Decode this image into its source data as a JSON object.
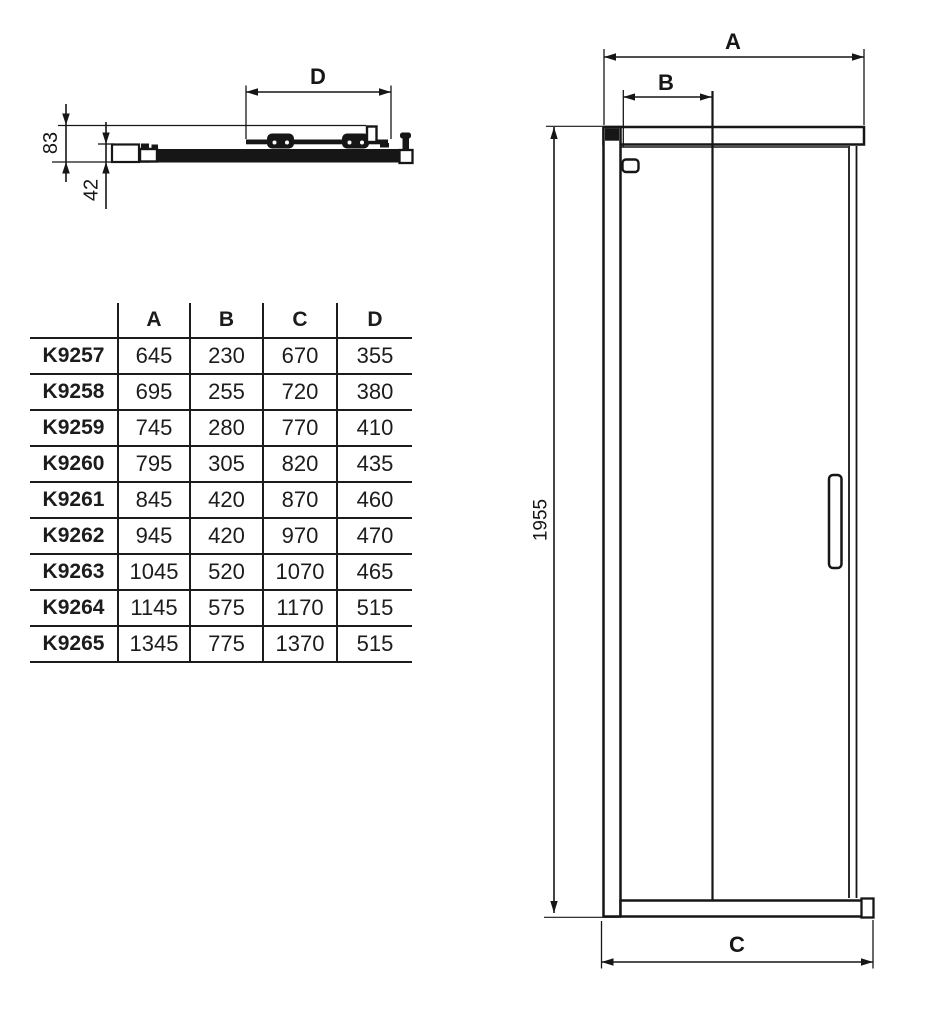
{
  "drawing": {
    "profile_section": {
      "dim_d": "D",
      "dim_depth": "83",
      "dim_inner": "42"
    },
    "elevation": {
      "dim_a": "A",
      "dim_b": "B",
      "dim_c": "C",
      "dim_height": "1955"
    }
  },
  "table": {
    "headers": [
      "A",
      "B",
      "C",
      "D"
    ],
    "rows": [
      {
        "model": "K9257",
        "values": [
          "645",
          "230",
          "670",
          "355"
        ]
      },
      {
        "model": "K9258",
        "values": [
          "695",
          "255",
          "720",
          "380"
        ]
      },
      {
        "model": "K9259",
        "values": [
          "745",
          "280",
          "770",
          "410"
        ]
      },
      {
        "model": "K9260",
        "values": [
          "795",
          "305",
          "820",
          "435"
        ]
      },
      {
        "model": "K9261",
        "values": [
          "845",
          "420",
          "870",
          "460"
        ]
      },
      {
        "model": "K9262",
        "values": [
          "945",
          "420",
          "970",
          "470"
        ]
      },
      {
        "model": "K9263",
        "values": [
          "1045",
          "520",
          "1070",
          "465"
        ]
      },
      {
        "model": "K9264",
        "values": [
          "1145",
          "575",
          "1170",
          "515"
        ]
      },
      {
        "model": "K9265",
        "values": [
          "1345",
          "775",
          "1370",
          "515"
        ]
      }
    ]
  },
  "colors": {
    "line": "#161616",
    "background": "#ffffff"
  }
}
